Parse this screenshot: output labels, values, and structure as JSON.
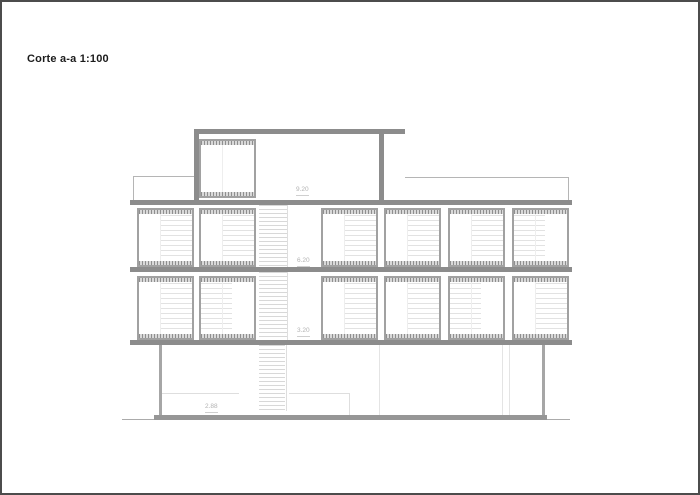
{
  "page": {
    "title": "Corte a-a 1:100"
  },
  "drawing": {
    "levels": [
      {
        "label": "9.20"
      },
      {
        "label": "6.20"
      },
      {
        "label": "3.20"
      },
      {
        "label": "2.88"
      }
    ]
  },
  "colors": {
    "line_dark": "#4c4c4c",
    "slab": "#8c8c8c",
    "frame": "#a1a1a1",
    "faint": "#e2e2e2",
    "label": "#b2b2b2"
  }
}
